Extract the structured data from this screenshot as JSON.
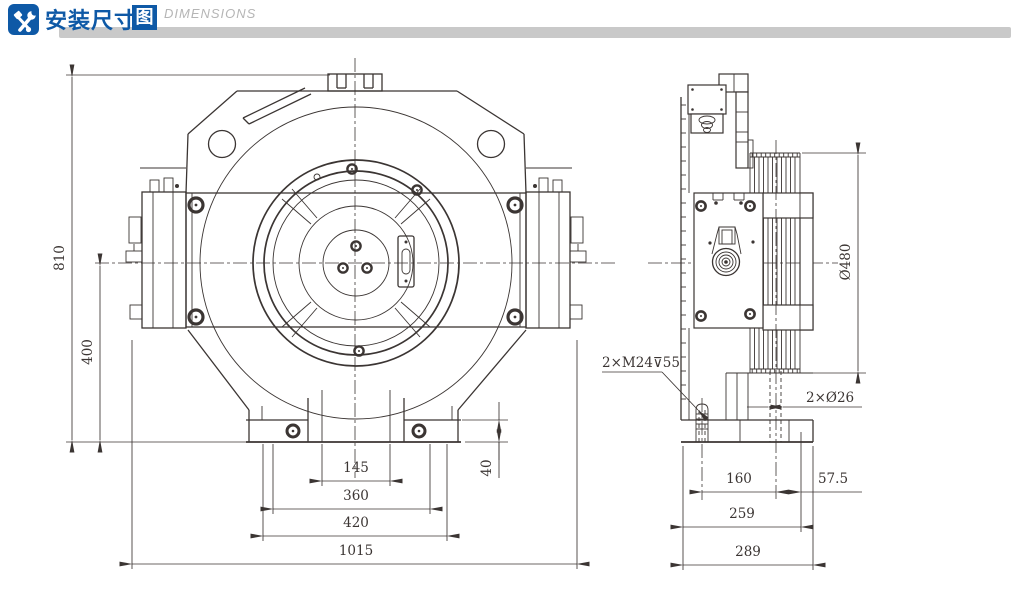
{
  "header": {
    "icon": "tools-icon",
    "title": "安装尺寸",
    "title_boxed": "图",
    "subtitle": "DIMENSIONS",
    "colors": {
      "accent": "#0e59a6",
      "bar": "#c9c9c9",
      "line": "#3b3533"
    }
  },
  "front_view": {
    "dims": {
      "overall_height": "810",
      "center_height": "400",
      "foot_height": "40",
      "inner_width": "145",
      "leg_width": "360",
      "foot_width": "420",
      "overall_width": "1015"
    }
  },
  "side_view": {
    "dims": {
      "sheave_diameter": "Ø480",
      "tapped_holes": "2×M24⊽55",
      "through_holes": "2×Ø26",
      "stud_to_center": "160",
      "center_to_edge": "57.5",
      "base_width": "259",
      "overall_depth": "289"
    }
  }
}
